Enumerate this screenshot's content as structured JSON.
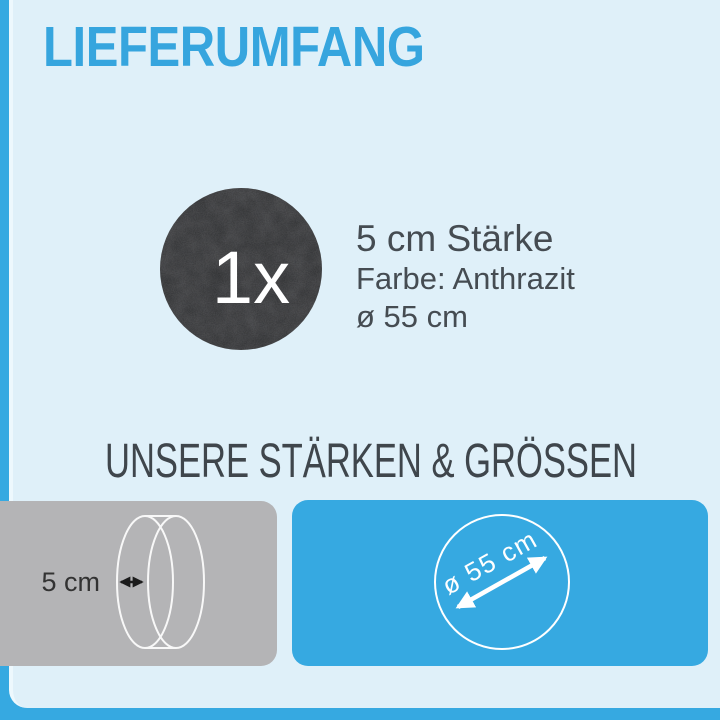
{
  "header": {
    "title": "LIEFERUMFANG"
  },
  "product": {
    "quantity": "1x",
    "thickness": "5 cm Stärke",
    "color": "Farbe: Anthrazit",
    "diameter": "ø 55 cm"
  },
  "sections": {
    "sizes_heading": "UNSERE STÄRKEN & GRÖSSEN"
  },
  "diagrams": {
    "thickness": {
      "label": "5 cm"
    },
    "diameter": {
      "label": "ø 55 cm"
    }
  },
  "colors": {
    "accent_blue": "#36a9e1",
    "title_blue": "#36a5de",
    "background_light": "#dff0f9",
    "edge_highlight": "#edf8fd",
    "gray_panel": "#b4b4b6",
    "felt_dark": "#2c2d2f",
    "heading_dark": "#3f464c",
    "text_dark": "#454c52",
    "diagram_line_white": "#ffffff",
    "diagram_arrow_black": "#1c1c1c"
  }
}
